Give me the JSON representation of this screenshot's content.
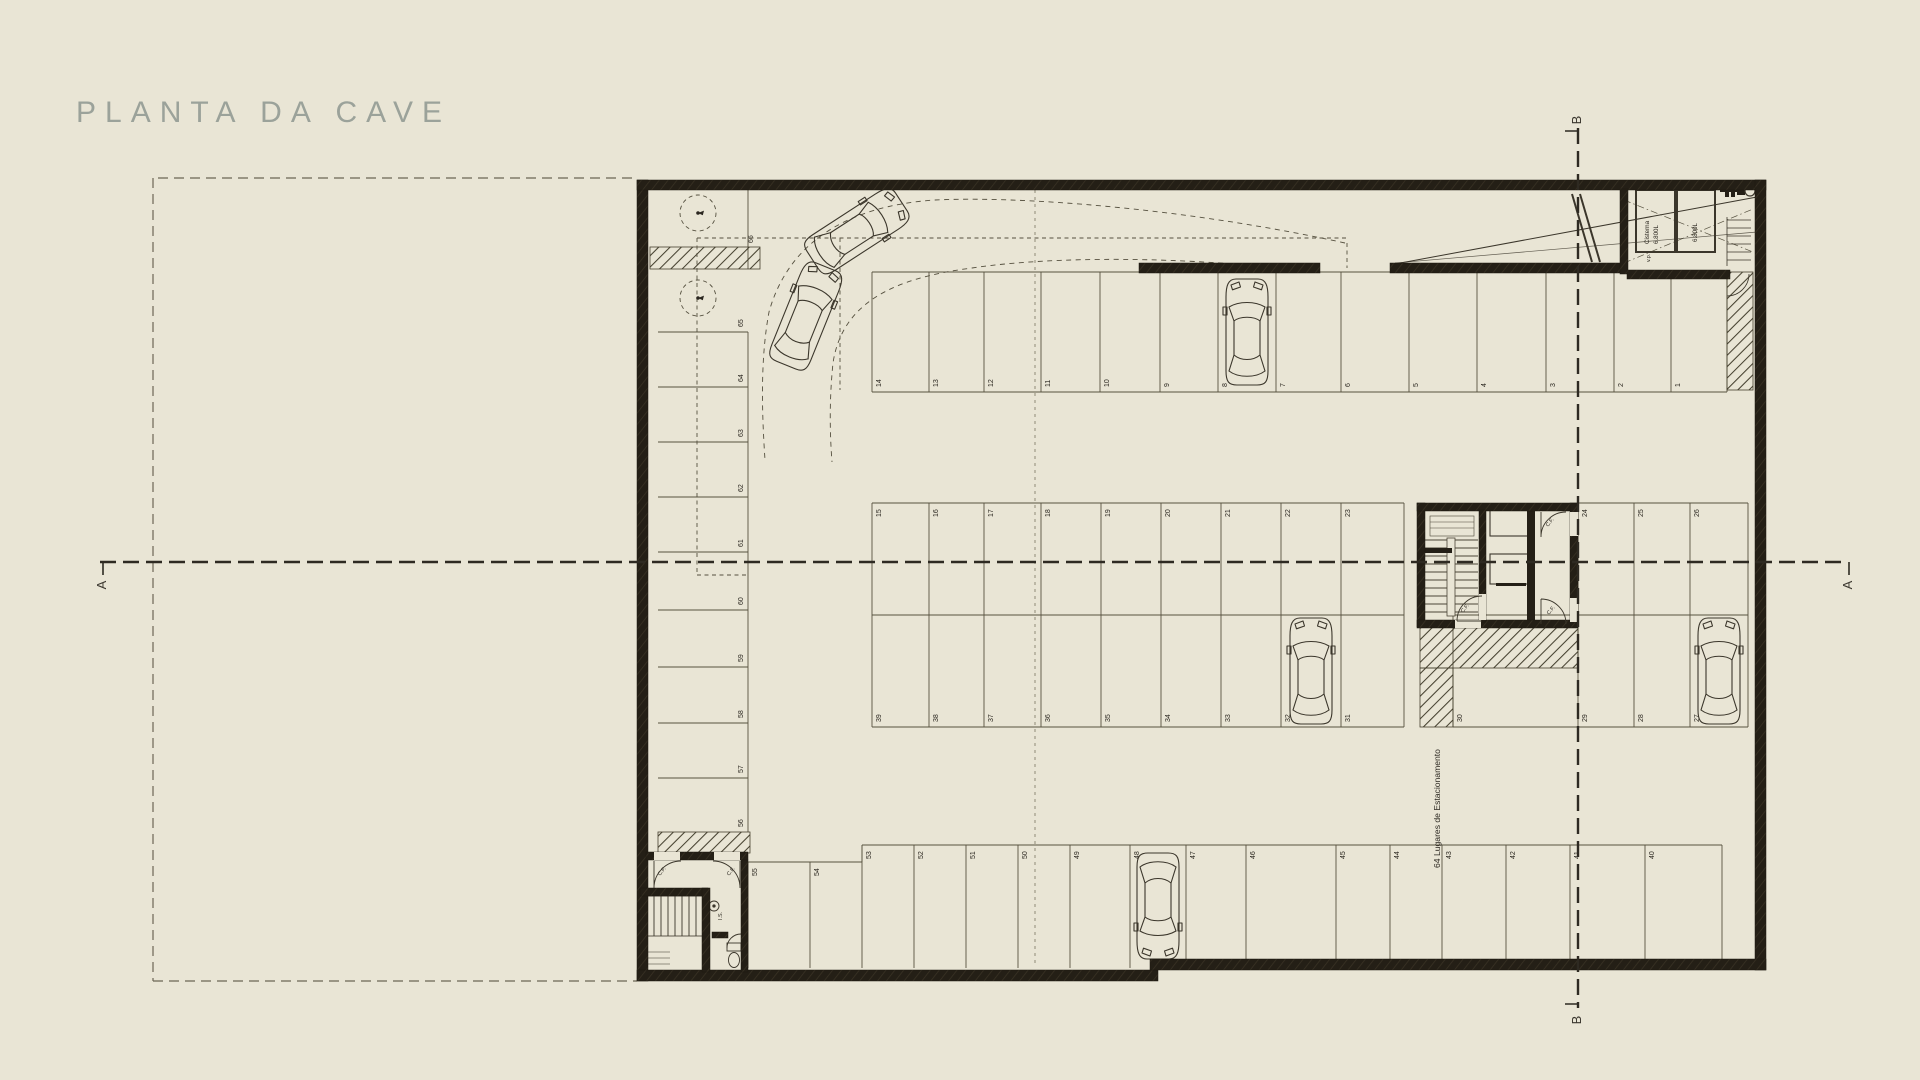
{
  "title": "PLANTA DA CAVE",
  "section_markers": {
    "a_left": "A",
    "a_right": "A",
    "b_top": "B",
    "b_bottom": "B"
  },
  "annotations": {
    "parking_count": "64 Lugares de Estacionamento",
    "cistern_label": "Cisterna",
    "cistern_capacity": "6.800L",
    "cistern_capacity_2": "6.800L",
    "fire_door": "C.F.",
    "vp": "v.p.",
    "wc": "I.S."
  },
  "stalls": {
    "left_column": [
      "66",
      "65",
      "64",
      "63",
      "62",
      "61",
      "60",
      "59",
      "58",
      "57",
      "56"
    ],
    "top_row": [
      "14",
      "13",
      "12",
      "11",
      "10",
      "9",
      "8",
      "7",
      "6",
      "5",
      "4",
      "3",
      "2",
      "1"
    ],
    "middle_top_left": [
      "15",
      "16",
      "17",
      "18",
      "19",
      "20",
      "21",
      "22",
      "23"
    ],
    "middle_top_right": [
      "24",
      "25",
      "26"
    ],
    "middle_bottom_left": [
      "39",
      "38",
      "37",
      "36",
      "35",
      "34",
      "33",
      "32",
      "31"
    ],
    "middle_bottom_right": [
      "30",
      "29",
      "28",
      "27"
    ],
    "bottom_row": [
      "55",
      "54",
      "53",
      "52",
      "51",
      "50",
      "49",
      "48",
      "47",
      "46",
      "45",
      "44",
      "43",
      "42",
      "41",
      "40"
    ]
  },
  "colors": {
    "background": "#e9e5d5",
    "wall": "#241f16",
    "line": "#57523f",
    "muted_title": "#9ba29a",
    "dashed": "#6c6655"
  }
}
